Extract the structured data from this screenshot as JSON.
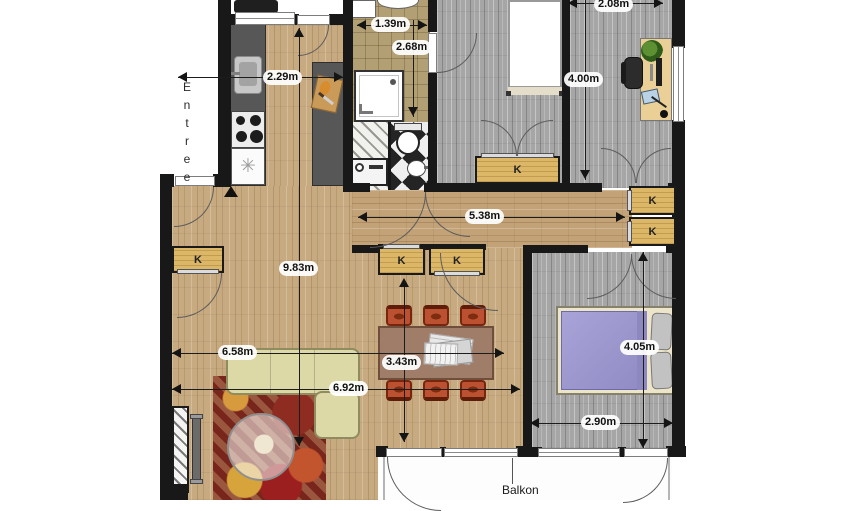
{
  "labels": {
    "entree": "Entree",
    "balkon": "Balkon",
    "closet": "K"
  },
  "measurements": {
    "kitchen_width": "2.29m",
    "bath_width": "1.39m",
    "bath_depth": "2.68m",
    "office_width": "2.08m",
    "office_depth": "4.00m",
    "hall_length": "5.38m",
    "living_depth": "9.83m",
    "living_width_upper": "6.58m",
    "living_width_lower": "6.92m",
    "dining_depth": "3.43m",
    "bedroom_depth": "4.05m",
    "bedroom_width": "2.90m"
  },
  "colors": {
    "wall": "#181818",
    "wood_light": "#c7aa80",
    "wood_gray": "#a6a6a6",
    "closet": "#ddb768",
    "bath_tile": "#b2a074",
    "counter": "#575757",
    "sofa": "#dcd9a7",
    "rug": "#7c2a20",
    "dining_chair": "#bb5130",
    "bed_blanket": "#9d99ce"
  }
}
